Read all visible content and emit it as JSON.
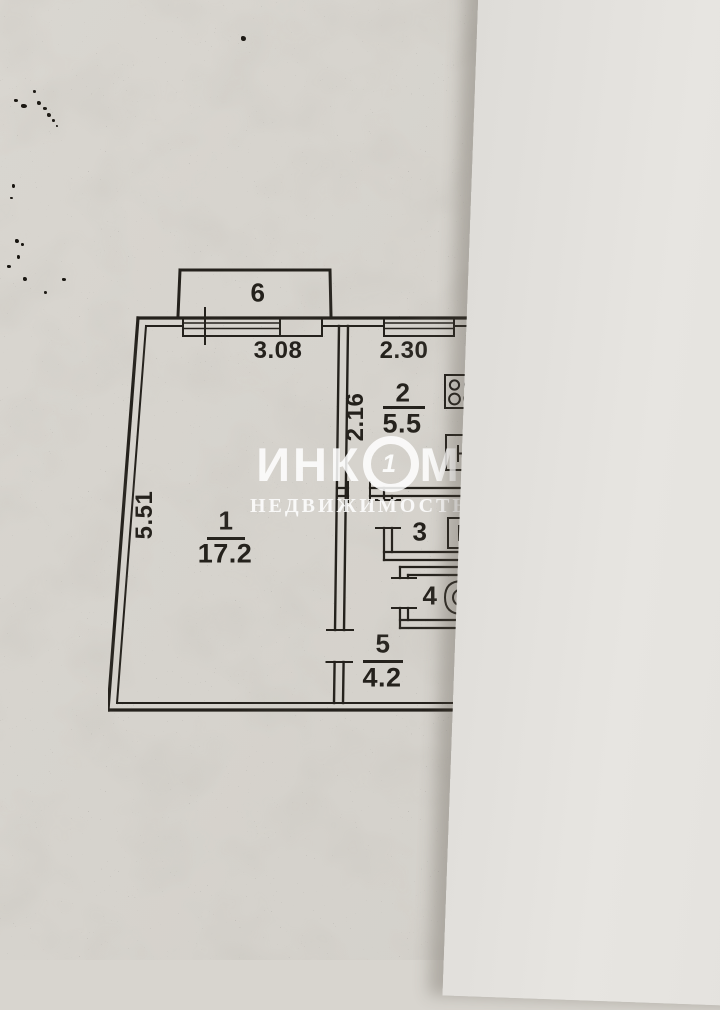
{
  "floorplan": {
    "rooms": {
      "living": {
        "num": "1",
        "area": "17.2"
      },
      "kitchen": {
        "num": "2",
        "area": "5.5"
      },
      "bathroom": {
        "num": "3"
      },
      "toilet": {
        "num": "4"
      },
      "hall": {
        "num": "5",
        "area": "4.2"
      },
      "balcony": {
        "num": "6"
      }
    },
    "dimensions": {
      "living_width": "3.08",
      "living_depth": "5.51",
      "kitchen_width": "2.30",
      "kitchen_depth": "2.16"
    }
  },
  "watermark": {
    "brand_left": "ИНК",
    "brand_right": "М",
    "logo_digit": "1",
    "subtitle": "НЕДВИЖИМОСТЬ"
  },
  "colors": {
    "ink": "#24211c",
    "paper": "#d6d3cd",
    "paper_overlap": "#e5e3df",
    "watermark_white": "#ffffff"
  },
  "icons": {
    "kitchen": [
      "stove-icon",
      "sink-icon"
    ],
    "bathroom": [
      "washbasin-icon"
    ],
    "toilet": [
      "toilet-icon"
    ]
  }
}
